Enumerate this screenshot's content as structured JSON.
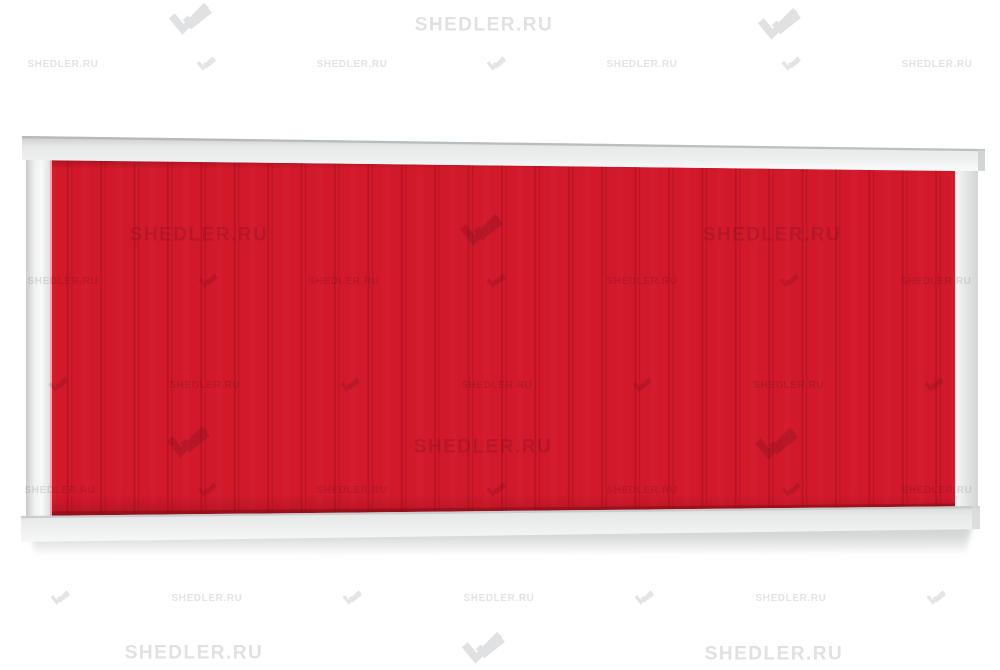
{
  "page": {
    "background": "#ffffff"
  },
  "brand": {
    "watermark_text": "SHEDLER.RU",
    "logo_name": "shedler-double-check-logo"
  },
  "colors": {
    "page-bg": "#ffffff",
    "panel-red": "#d1192a",
    "panel-groove": "#a81020",
    "panel-groove-soft": "#8f0d1a",
    "panel-edge-shadow": "#7d0a16",
    "frame-top-edge": "#aeb1b1",
    "frame-dark": "#c9cbcb",
    "frame-mid": "#e7e8e8",
    "frame-light": "#f8f8f8",
    "ground-shadow": "#a8acae",
    "wm-color": "#dfe1e3"
  },
  "fence": {
    "parts": [
      "top-rail",
      "left-post",
      "right-post",
      "profiled-sheet",
      "bottom-rail",
      "ground-shadow"
    ]
  },
  "watermarks": {
    "text": "SHEDLER.RU",
    "items": [
      {
        "kind": "logo-lg",
        "x": 192,
        "y": 22
      },
      {
        "kind": "text-lg",
        "x": 484,
        "y": 25
      },
      {
        "kind": "logo-lg",
        "x": 781,
        "y": 27
      },
      {
        "kind": "text-sm",
        "x": 63,
        "y": 65
      },
      {
        "kind": "logo-sm",
        "x": 207,
        "y": 65
      },
      {
        "kind": "text-sm",
        "x": 352,
        "y": 65
      },
      {
        "kind": "logo-sm",
        "x": 497,
        "y": 65
      },
      {
        "kind": "text-sm",
        "x": 642,
        "y": 65
      },
      {
        "kind": "logo-sm",
        "x": 792,
        "y": 65
      },
      {
        "kind": "text-sm",
        "x": 937,
        "y": 65
      },
      {
        "kind": "text-lg",
        "x": 199,
        "y": 235
      },
      {
        "kind": "logo-lg",
        "x": 483,
        "y": 233
      },
      {
        "kind": "text-lg",
        "x": 772,
        "y": 235
      },
      {
        "kind": "text-sm",
        "x": 63,
        "y": 282
      },
      {
        "kind": "logo-sm",
        "x": 209,
        "y": 282
      },
      {
        "kind": "text-sm",
        "x": 344,
        "y": 282
      },
      {
        "kind": "logo-sm",
        "x": 497,
        "y": 282
      },
      {
        "kind": "text-sm",
        "x": 642,
        "y": 282
      },
      {
        "kind": "logo-sm",
        "x": 790,
        "y": 282
      },
      {
        "kind": "text-sm",
        "x": 936,
        "y": 282
      },
      {
        "kind": "logo-sm",
        "x": 59,
        "y": 386
      },
      {
        "kind": "text-sm",
        "x": 205,
        "y": 386
      },
      {
        "kind": "logo-sm",
        "x": 351,
        "y": 386
      },
      {
        "kind": "text-sm",
        "x": 497,
        "y": 386
      },
      {
        "kind": "logo-sm",
        "x": 643,
        "y": 386
      },
      {
        "kind": "text-sm",
        "x": 789,
        "y": 386
      },
      {
        "kind": "logo-sm",
        "x": 935,
        "y": 386
      },
      {
        "kind": "logo-lg",
        "x": 190,
        "y": 445
      },
      {
        "kind": "text-lg",
        "x": 483,
        "y": 447
      },
      {
        "kind": "logo-lg",
        "x": 778,
        "y": 447
      },
      {
        "kind": "text-sm",
        "x": 60,
        "y": 491
      },
      {
        "kind": "logo-sm",
        "x": 208,
        "y": 491
      },
      {
        "kind": "text-sm",
        "x": 352,
        "y": 491
      },
      {
        "kind": "logo-sm",
        "x": 497,
        "y": 491
      },
      {
        "kind": "text-sm",
        "x": 642,
        "y": 491
      },
      {
        "kind": "logo-sm",
        "x": 792,
        "y": 491
      },
      {
        "kind": "text-sm",
        "x": 937,
        "y": 491
      },
      {
        "kind": "logo-sm",
        "x": 61,
        "y": 599
      },
      {
        "kind": "text-sm",
        "x": 207,
        "y": 599
      },
      {
        "kind": "logo-sm",
        "x": 353,
        "y": 599
      },
      {
        "kind": "text-sm",
        "x": 499,
        "y": 599
      },
      {
        "kind": "logo-sm",
        "x": 645,
        "y": 599
      },
      {
        "kind": "text-sm",
        "x": 791,
        "y": 599
      },
      {
        "kind": "logo-sm",
        "x": 937,
        "y": 599
      },
      {
        "kind": "text-lg",
        "x": 194,
        "y": 653
      },
      {
        "kind": "logo-lg",
        "x": 485,
        "y": 651
      },
      {
        "kind": "text-lg",
        "x": 774,
        "y": 654
      }
    ]
  }
}
